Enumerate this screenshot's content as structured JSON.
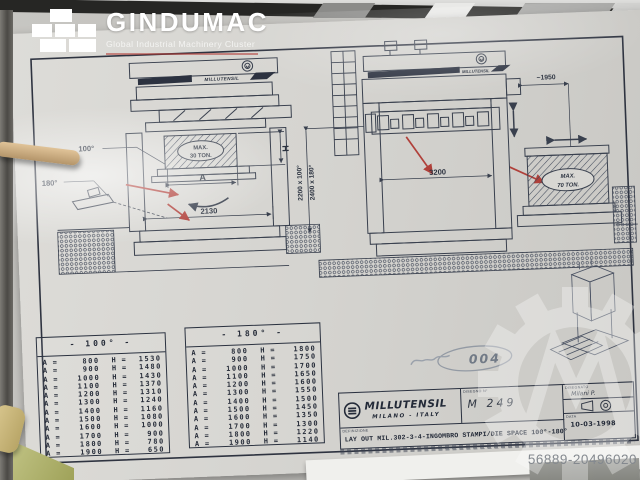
{
  "overlay": {
    "brand": "GINDUMAC",
    "tagline": "Global Industrial Machinery Cluster",
    "photo_id": "56889-20496020"
  },
  "drawing": {
    "front_view": {
      "brand": "MILLUTENSIL",
      "angle_open": "100°",
      "angle_open_full": "180°",
      "die_max_line1": "MAX.",
      "die_max_line2": "30 TON.",
      "dim_a": "A",
      "dim_h": "H",
      "dim_width": "2130"
    },
    "side_view": {
      "brand": "MILLUTENSIL",
      "dim_width": "3200",
      "dim_offset": "~1950",
      "dim_height_100": "2200 x 100°",
      "dim_height_180": "2400 x 180°"
    },
    "die_70": {
      "line1": "MAX.",
      "line2": "70 TON."
    },
    "handwritten_note": "004"
  },
  "tables": [
    {
      "title": "- 100° -",
      "rows": [
        {
          "a": "800",
          "h": "1530"
        },
        {
          "a": "900",
          "h": "1480"
        },
        {
          "a": "1000",
          "h": "1430"
        },
        {
          "a": "1100",
          "h": "1370"
        },
        {
          "a": "1200",
          "h": "1310"
        },
        {
          "a": "1300",
          "h": "1240"
        },
        {
          "a": "1400",
          "h": "1160"
        },
        {
          "a": "1500",
          "h": "1080"
        },
        {
          "a": "1600",
          "h": "1000"
        },
        {
          "a": "1700",
          "h": "900"
        },
        {
          "a": "1800",
          "h": "780"
        },
        {
          "a": "1900",
          "h": "650"
        }
      ]
    },
    {
      "title": "- 180° -",
      "rows": [
        {
          "a": "800",
          "h": "1800"
        },
        {
          "a": "900",
          "h": "1750"
        },
        {
          "a": "1000",
          "h": "1700"
        },
        {
          "a": "1100",
          "h": "1650"
        },
        {
          "a": "1200",
          "h": "1600"
        },
        {
          "a": "1300",
          "h": "1550"
        },
        {
          "a": "1400",
          "h": "1500"
        },
        {
          "a": "1500",
          "h": "1450"
        },
        {
          "a": "1600",
          "h": "1350"
        },
        {
          "a": "1700",
          "h": "1300"
        },
        {
          "a": "1800",
          "h": "1220"
        },
        {
          "a": "1900",
          "h": "1140"
        }
      ]
    }
  ],
  "title_block": {
    "brand": "MILLUTENSIL",
    "city": "MILANO - ITALY",
    "drawing_no_label": "DISEGNO N°",
    "drawing_no": "M 249",
    "definition_label": "DEFINIZIONE",
    "definition": "LAY OUT MIL.302-3-4-INGOMBRO STAMPI/DIE SPACE 100°-180°",
    "drawn_label": "DISEGNATO",
    "drawn_by": "Milani P.",
    "date_label": "DATA",
    "date": "10-03-1998"
  },
  "colors": {
    "paper": "#d6d5d1",
    "ink": "#39404e",
    "annotation_red": "#b0403a"
  }
}
